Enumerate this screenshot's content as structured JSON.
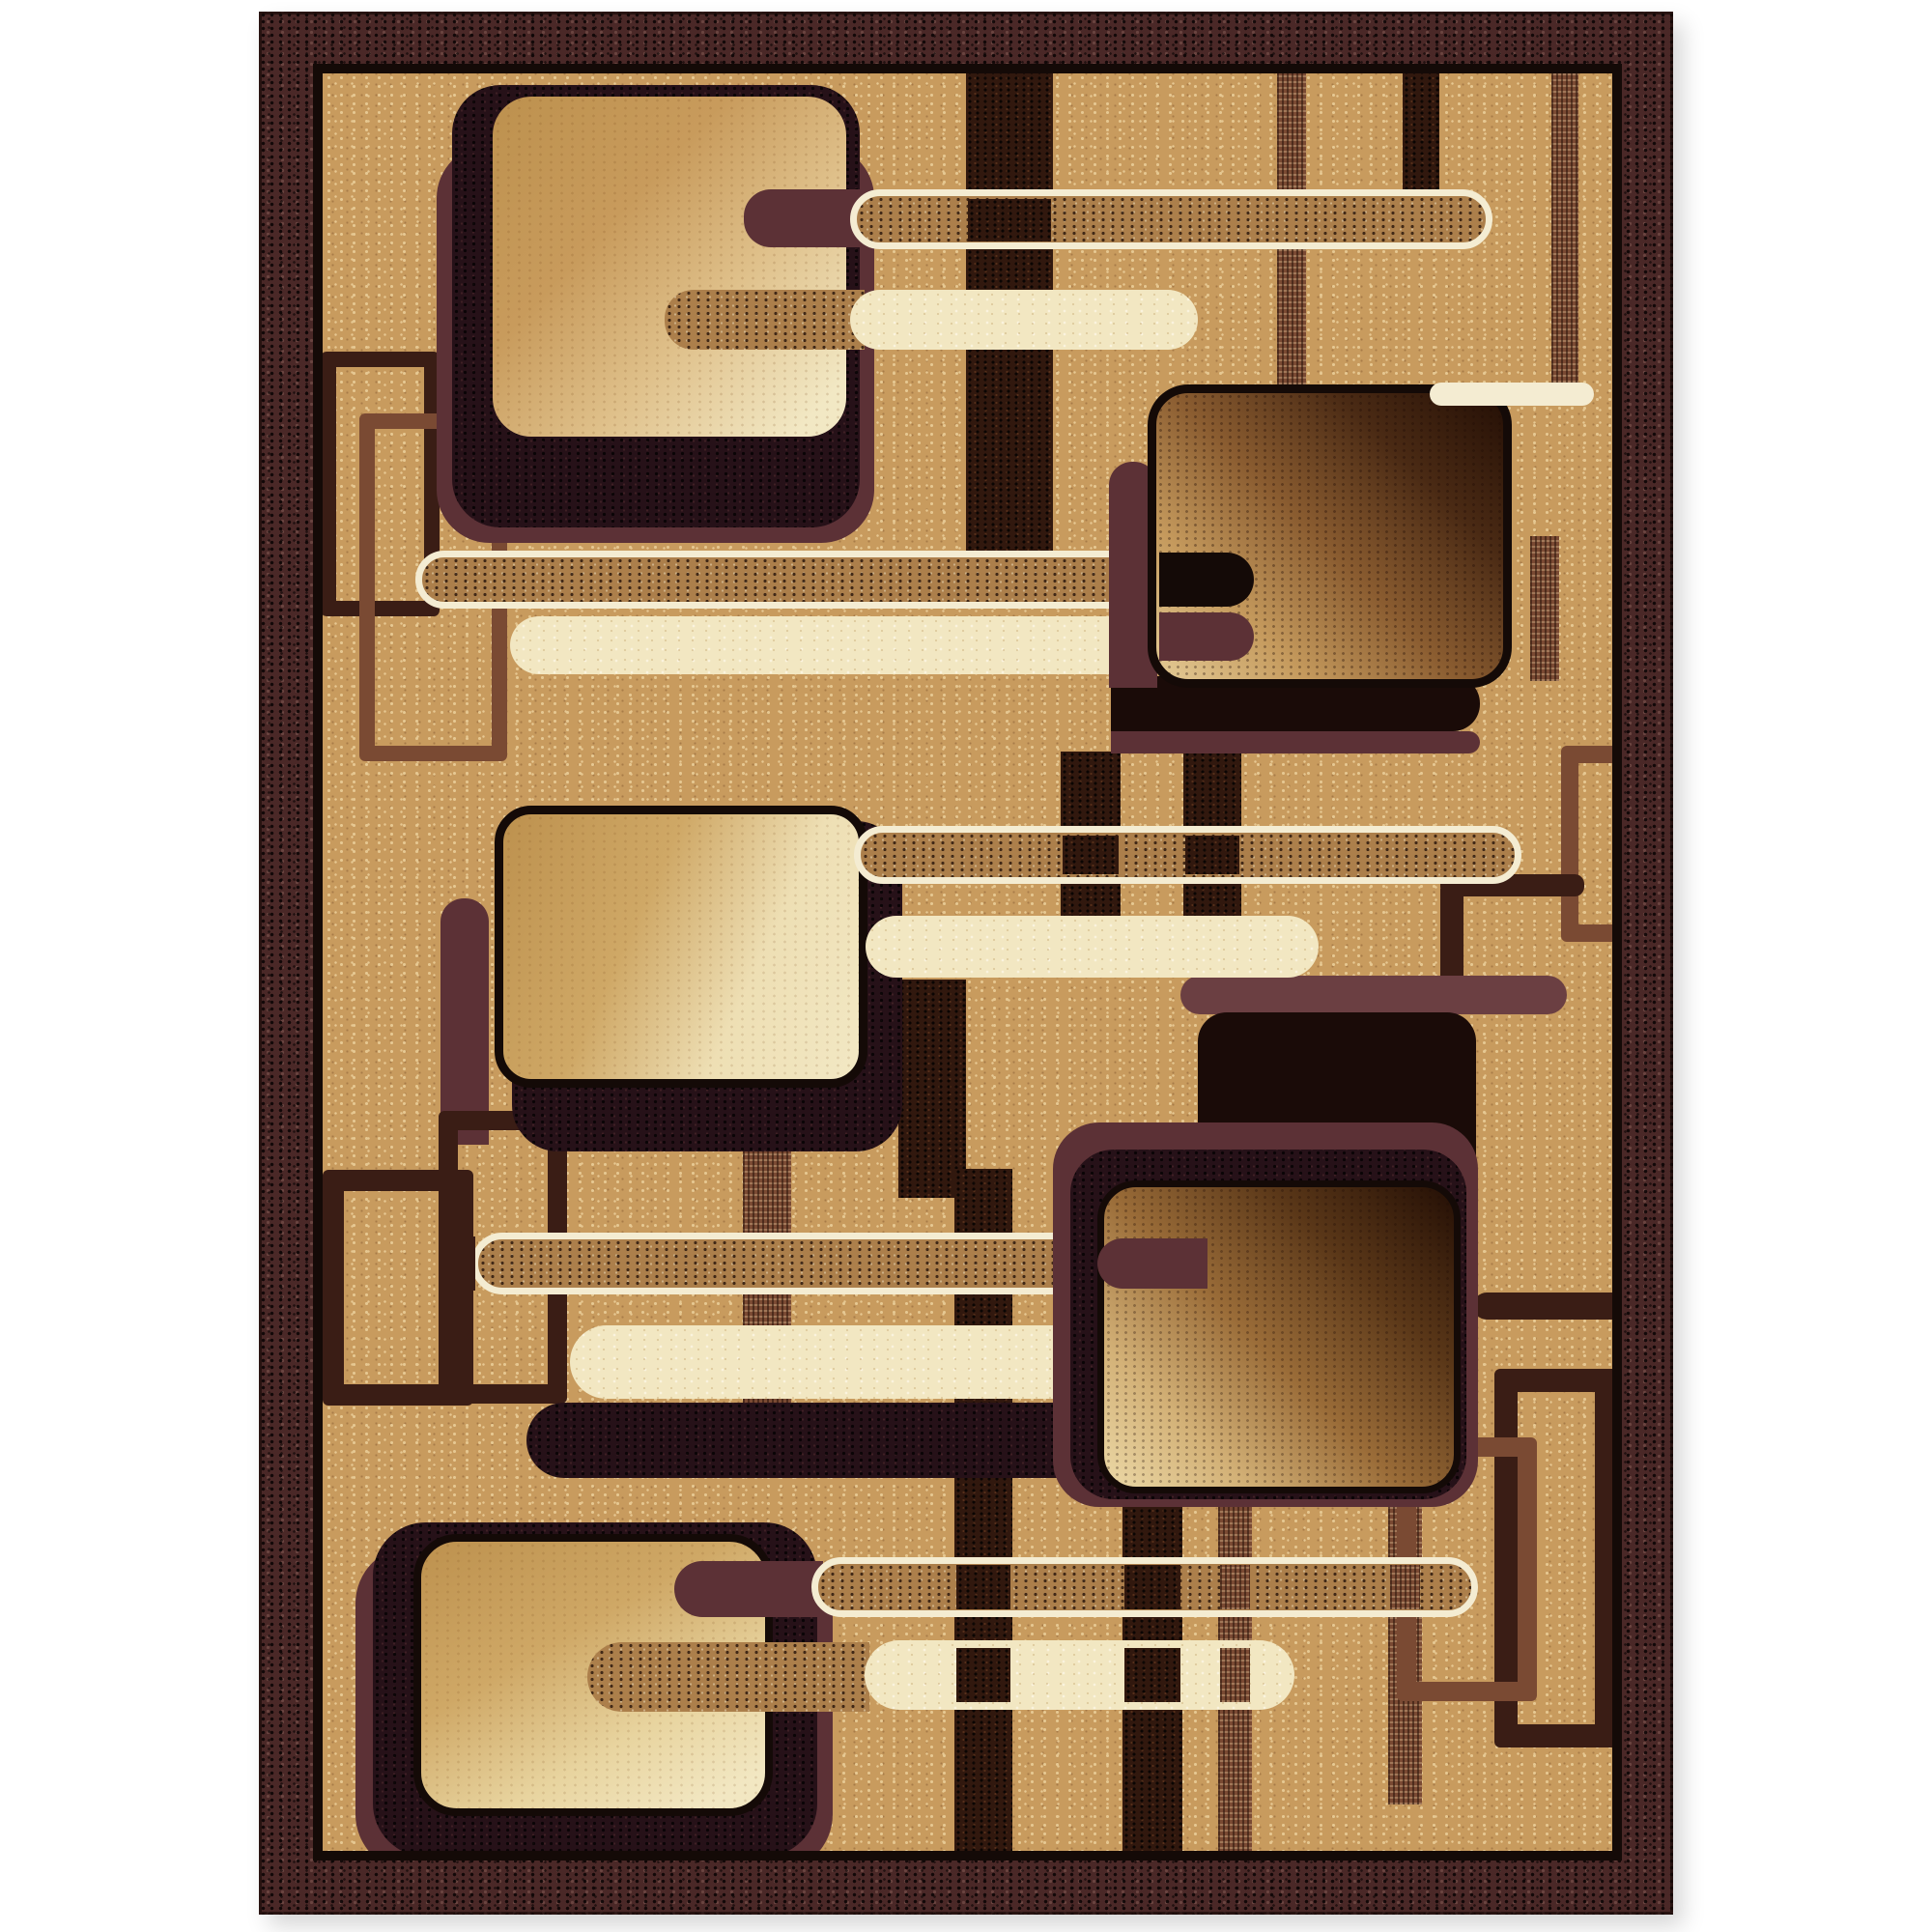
{
  "image": {
    "type": "product-photograph",
    "subject": "rectangular area rug with abstract retro geometric pattern",
    "background": "#ffffff"
  },
  "palette": {
    "white_bg": "#ffffff",
    "border_maroon": "#4a2827",
    "line_black": "#140a07",
    "field_tan": "#c89b5e",
    "fleck_light": "#e6c892",
    "fleck_dark": "#8a5f32",
    "maroon": "#5c3136",
    "maroon_light": "#6b3f42",
    "cream": "#f2e7c2",
    "cream_line": "#f4ecd2",
    "bar_speckle": "#ac7f4b",
    "strap_dark": "#31180e",
    "stitch_brown": "#7a4a33",
    "thin_dark": "#3a1d15",
    "shadow_black": "#1a0b08",
    "shadow_fill": "#261118",
    "sq_fill_light": "#f2e8c4",
    "sq_fill_mid": "#cfa866",
    "sq_fill_tan": "#bd914e",
    "sq_fill_dark": "#240f05"
  },
  "rug": {
    "border": "speckled dark maroon band with thin black inner line",
    "field": "speckled tan",
    "motif_counts": {
      "large_gradient_squares": 5,
      "shadow_squares": 5,
      "thin_outline_squares": 7,
      "outlined_speckled_bars": 5,
      "solid_cream_bars": 5,
      "vertical_straps": 12
    }
  }
}
